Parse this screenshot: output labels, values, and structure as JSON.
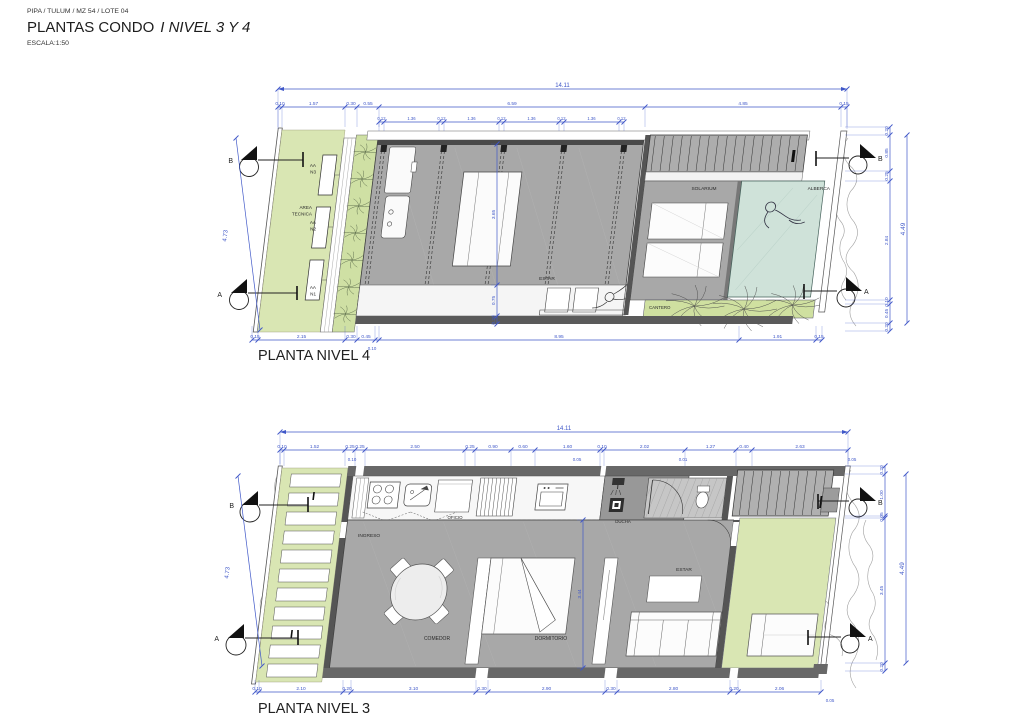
{
  "header": {
    "project": "PIPA / TULUM / MZ 54 / LOTE 04",
    "title_main": "PLANTAS CONDO",
    "title_italic": "I NIVEL 3 Y 4",
    "scale": "ESCALA:1:50"
  },
  "sections": {
    "a": "A",
    "b": "B"
  },
  "plan4": {
    "title": "PLANTA NIVEL 4",
    "dims_total": [
      "14.11"
    ],
    "dims_top": [
      "0.10",
      "1.57",
      "0.30",
      "0.55",
      "6.59",
      "4.85",
      "0.15"
    ],
    "dims_beams": [
      "0.12",
      "1.36",
      "0.12",
      "1.36",
      "0.12",
      "1.36",
      "0.12",
      "1.36",
      "0.12"
    ],
    "dims_bottom": [
      "0.15",
      "2.15",
      "0.30",
      "0.45",
      "0.10",
      "8.95",
      "1.91",
      "0.15"
    ],
    "dims_right": [
      "0.20",
      "0.85",
      "0.25",
      "2.84",
      "0.10",
      "0.45",
      "0.20"
    ],
    "dims_right_total": [
      "4.49"
    ],
    "dims_left_total": [
      "4.73"
    ],
    "dims_interior": [
      "3.65",
      "0.75",
      "0.20"
    ],
    "labels": {
      "aa3a": "AA",
      "n3": "N3",
      "area": "AREA",
      "tecnica": "TECNICA",
      "aa2a": "AA",
      "n2": "N2",
      "aa1a": "AA",
      "n1": "N1",
      "estar": "ESTAR",
      "solarium": "SOLARIUM",
      "alberca": "ALBERCA",
      "cantero": "CANTERO"
    }
  },
  "plan3": {
    "title": "PLANTA NIVEL 3",
    "dims_total": [
      "14.11"
    ],
    "dims_top": [
      "0.10",
      "1.52",
      "0.25",
      "0.25",
      "2.50",
      "0.25",
      "0.90",
      "0.60",
      "1.60",
      "0.10",
      "2.02",
      "1.27",
      "0.40",
      "2.63"
    ],
    "dims_top_sub": [
      "0.10",
      "0.05",
      "0.01",
      "0.05"
    ],
    "dims_bottom": [
      "0.10",
      "2.10",
      "0.20",
      "3.10",
      "0.30",
      "2.90",
      "0.30",
      "2.80",
      "0.20",
      "2.06"
    ],
    "dims_bottom_sub": [
      "0.05"
    ],
    "dims_right": [
      "0.20",
      "1.00",
      "0.05",
      "3.45",
      "0.20"
    ],
    "dims_right_total": [
      "4.49"
    ],
    "dims_left_total": [
      "4.73"
    ],
    "dims_interior": [
      "3.44"
    ],
    "labels": {
      "oficio": "OFICIO",
      "ingreso": "INGRESO",
      "comedor": "COMEDOR",
      "dormitorio": "DORMITORIO",
      "ducha": "DUCHA",
      "estar": "ESTAR"
    }
  }
}
